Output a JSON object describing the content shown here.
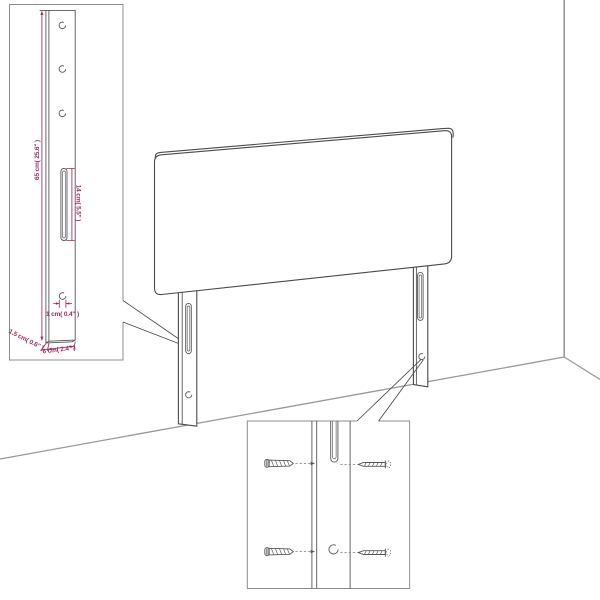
{
  "figure": {
    "type": "product-dimension-diagram",
    "subject": "headboard-with-two-slotted-legs",
    "labels": {
      "leg_height": "65 cm( 25.6\" )",
      "slot_length": "14 cm( 5.5\" )",
      "hole_diameter": "1 cm( 0.4\" )",
      "leg_thickness": "1.5 cm( 0.6\" )",
      "leg_width": "6 cm( 2.4\" )"
    },
    "colors": {
      "dimension_text": "#9C2C63",
      "drawing_line": "#4A4A4A",
      "detail_line": "#565656",
      "wall_line": "#989898",
      "box_border": "#8C8C8C",
      "background": "#FFFFFF"
    }
  }
}
